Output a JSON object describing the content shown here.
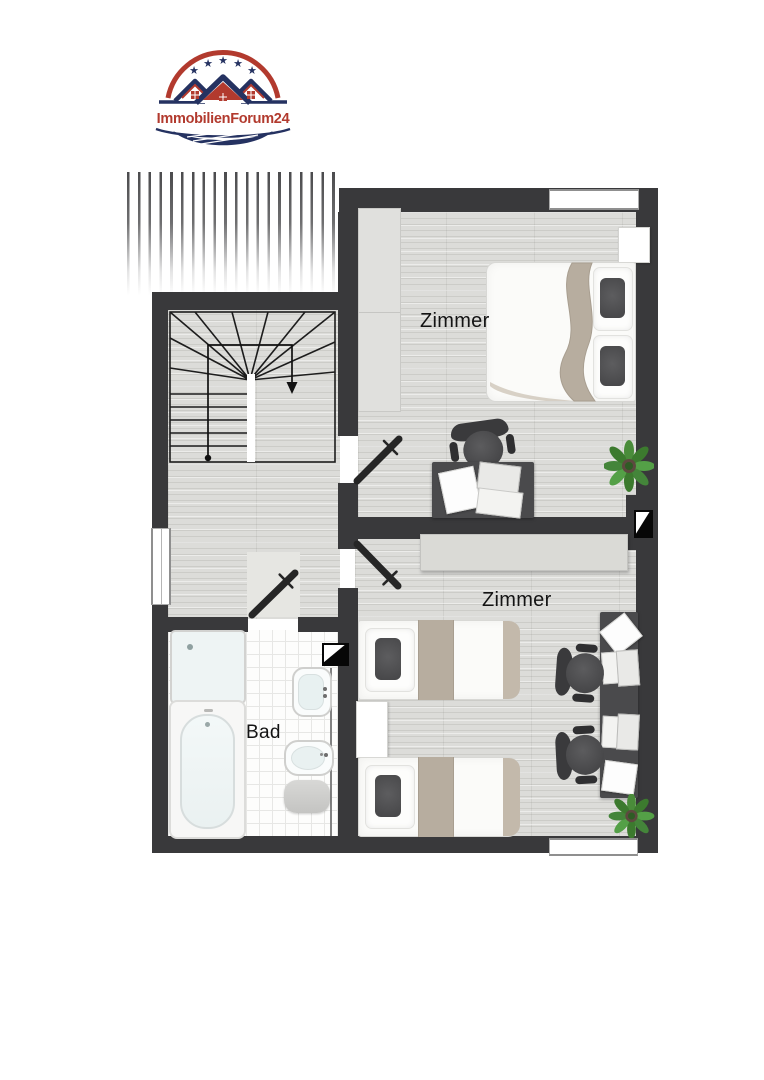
{
  "logo": {
    "brand": "ImmobilienForum24",
    "colors": {
      "navy": "#253261",
      "red": "#b23a2e"
    }
  },
  "rooms": {
    "top": {
      "label": "Zimmer"
    },
    "bottom": {
      "label": "Zimmer"
    },
    "bath": {
      "label": "Bad"
    }
  },
  "palette": {
    "wall": "#39393b",
    "wood_floor": "#dcdcd9",
    "bath_tile": "#fdfdfc",
    "blanket_beige": "#b7ad9f",
    "furniture_dark": "#4a4a4c",
    "plant_green": "#4a8c3a",
    "door_leaf": "#262626"
  },
  "icons": {
    "roof_slope": "roof-slope-hatching",
    "staircase": "winder-staircase-down-arrow",
    "chimney": "chimney-shaft-symbol",
    "door": "open-door-leaf"
  },
  "furniture": {
    "top_room": [
      "wardrobe",
      "double-bed",
      "nightstand",
      "desk",
      "office-chair",
      "laptop",
      "paper",
      "plant"
    ],
    "bottom_room": [
      "sideboard",
      "single-bed",
      "single-bed",
      "nightstand",
      "desk",
      "office-chair",
      "office-chair",
      "laptop",
      "laptop",
      "paper",
      "plant"
    ],
    "bath": [
      "shower",
      "bathtub",
      "wash-basin",
      "toilet",
      "bath-mat"
    ]
  }
}
